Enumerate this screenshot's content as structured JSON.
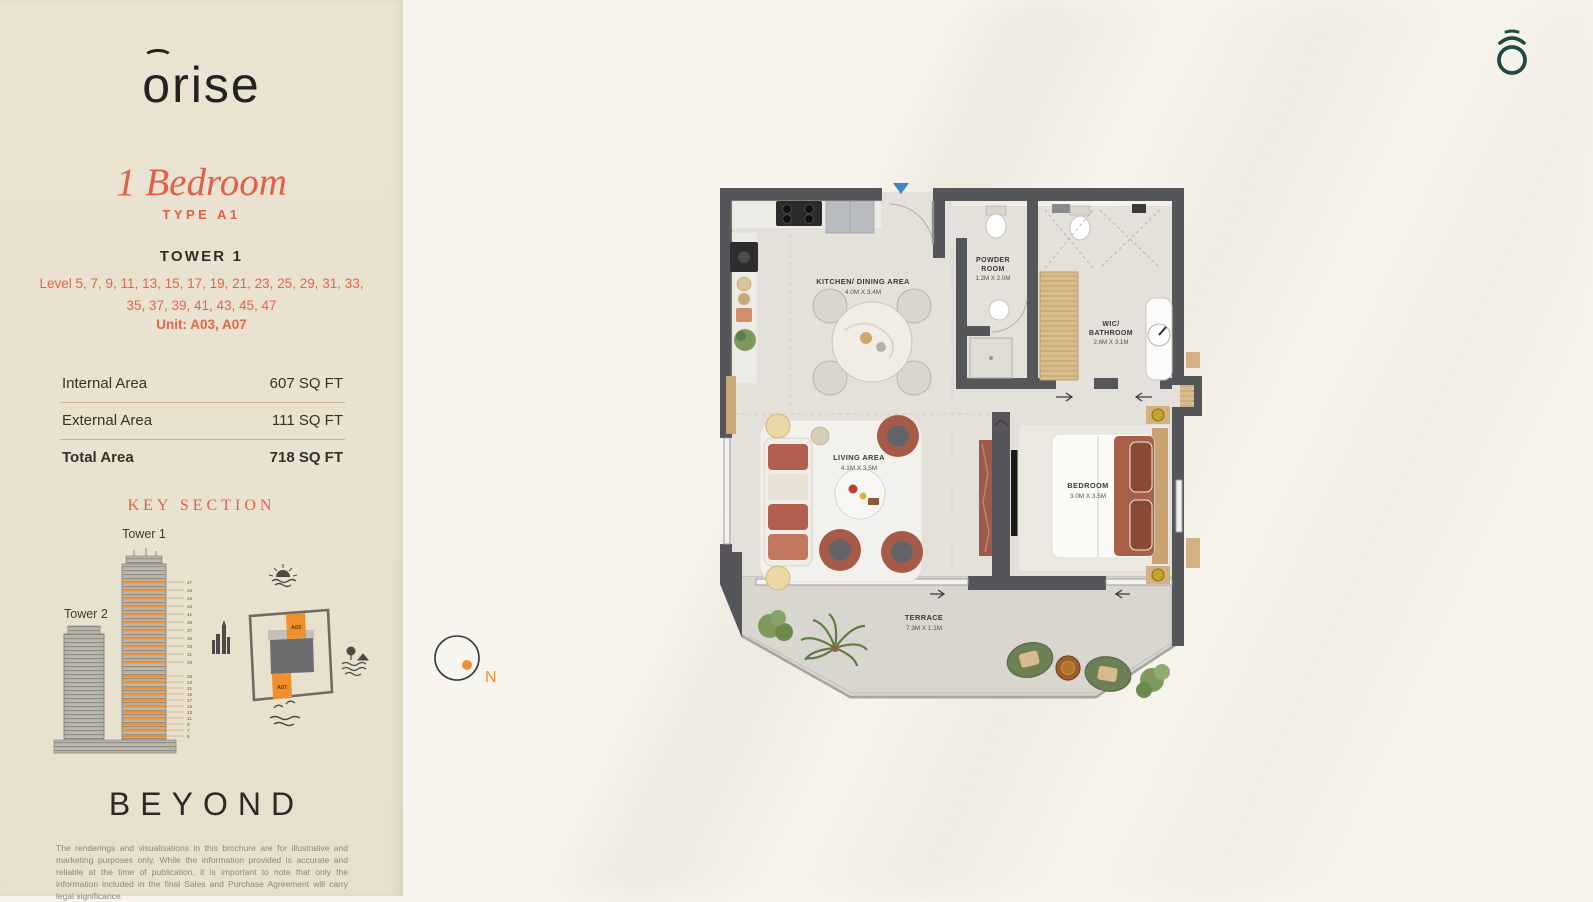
{
  "brand": {
    "logo_o": "o",
    "logo_rest": "rise",
    "beyond": "BEYOND"
  },
  "header": {
    "title": "1 Bedroom",
    "type_label": "TYPE A1",
    "tower": "TOWER 1",
    "levels_line1": "Level 5, 7, 9, 11, 13, 15, 17, 19, 21, 23, 25, 29, 31, 33,",
    "levels_line2": "35, 37, 39, 41, 43, 45, 47",
    "unit": "Unit: A03, A07"
  },
  "areas": {
    "rows": [
      {
        "label": "Internal Area",
        "value": "607 SQ FT"
      },
      {
        "label": "External Area",
        "value": "111 SQ FT"
      },
      {
        "label": "Total Area",
        "value": "718 SQ FT"
      }
    ]
  },
  "key_section": {
    "title": "KEY SECTION",
    "tower1": "Tower 1",
    "tower2": "Tower 2",
    "unit_top": "A03",
    "unit_bottom": "A07",
    "floors": [
      "47",
      "46",
      "45",
      "43",
      "41",
      "39",
      "37",
      "35",
      "33",
      "31",
      "29",
      "25",
      "23",
      "21",
      "19",
      "17",
      "15",
      "13",
      "11",
      "9",
      "7",
      "5"
    ]
  },
  "floorplan": {
    "kitchen": {
      "name": "KITCHEN/ DINING AREA",
      "dims": "4.0M X 3.4M"
    },
    "powder": {
      "name1": "POWDER",
      "name2": "ROOM",
      "dims": "1.2M X 2.0M"
    },
    "wic": {
      "name1": "WIC/",
      "name2": "BATHROOM",
      "dims": "2.6M X 3.1M"
    },
    "living": {
      "name": "LIVING AREA",
      "dims": "4.1M X 3.5M"
    },
    "bedroom": {
      "name": "BEDROOM",
      "dims": "3.0M X 3.5M"
    },
    "terrace": {
      "name": "TERRACE",
      "dims": "7.3M X 1.1M"
    },
    "compass": "N"
  },
  "footer": {
    "disclaimer": "The renderings and visualisations in this brochure are for illustrative and marketing purposes only. While the information provided is accurate and reliable at the time of publication, it is important to note that only the information included in the final Sales and Purchase Agreement will carry legal significance."
  },
  "colors": {
    "coral": "#df604b",
    "orange": "#ef8f2e",
    "teal": "#1f4a42",
    "sidebar_bg": "#e9e2cf",
    "canvas_bg": "#f8f5ee",
    "wall": "#55565a"
  }
}
